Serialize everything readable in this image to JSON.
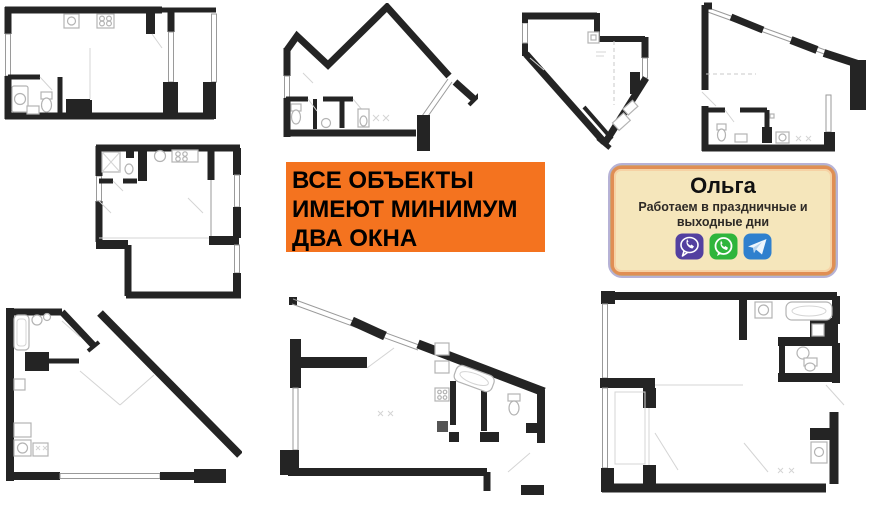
{
  "page": {
    "background_color": "#ffffff"
  },
  "banner": {
    "line1": "ВСЕ ОБЪЕКТЫ",
    "line2": "ИМЕЮТ МИНИМУМ",
    "line3": "ДВА ОКНА",
    "bg_color": "#F4731F",
    "text_color": "#000000"
  },
  "contact_card": {
    "name": "Ольга",
    "subtitle": "Работаем в праздничные и выходные дни",
    "bg_color": "#F5E6BB",
    "border_color": "#E08E54",
    "outer_border_color": "#B6B2D6",
    "icons": [
      {
        "name": "viber-icon",
        "color": "#5340A0"
      },
      {
        "name": "whatsapp-icon",
        "color": "#2FB53C"
      },
      {
        "name": "telegram-icon",
        "color": "#2F80CE"
      }
    ]
  },
  "floorplans": {
    "wall_color": "#242424",
    "fixture_color": "#B3B3B3",
    "count": 8,
    "items": [
      {
        "id": "floorplan-1",
        "position": "top-left"
      },
      {
        "id": "floorplan-2",
        "position": "top-middle"
      },
      {
        "id": "floorplan-3",
        "position": "top-center-right"
      },
      {
        "id": "floorplan-4",
        "position": "top-right"
      },
      {
        "id": "floorplan-5",
        "position": "middle-left"
      },
      {
        "id": "floorplan-6",
        "position": "bottom-left"
      },
      {
        "id": "floorplan-7",
        "position": "bottom-middle"
      },
      {
        "id": "floorplan-8",
        "position": "bottom-right"
      }
    ]
  }
}
